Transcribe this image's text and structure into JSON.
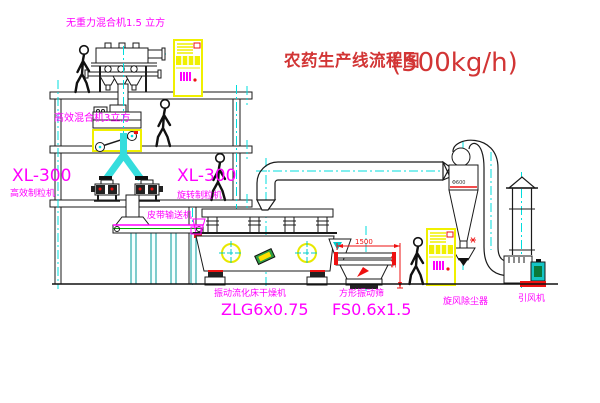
{
  "title": {
    "text": "农药生产线流程图",
    "capacity": "(500kg/h)"
  },
  "equipment_labels": {
    "gravity_mixer": "无重力混合机1.5 立方",
    "high_eff_mixer": "高效混合机3立方",
    "granulator_left_model": "XL-300",
    "granulator_left_name": "高效制粒机",
    "granulator_right_model": "XL-300",
    "granulator_right_name": "旋转制粒机",
    "belt_conveyor": "皮带输送机",
    "dryer_name": "振动流化床干燥机",
    "dryer_model": "ZLG6x0.75",
    "sieve_name": "方形振动筛",
    "sieve_model": "FS0.6x1.5",
    "cyclone_name": "旋风除尘器",
    "fan_name": "引风机"
  },
  "dimensions": {
    "sieve_width": "1500",
    "sieve_height": "541",
    "cyclone_diameter": "Φ600"
  },
  "colors": {
    "line": "#1a1a1a",
    "centerline": "#00dddd",
    "label": "#ff00ff",
    "title_red": "#d23535",
    "dimension_red": "#ee1111",
    "cabinet_yellow": "#f0f000",
    "pipe_cyan": "#35dddd"
  }
}
